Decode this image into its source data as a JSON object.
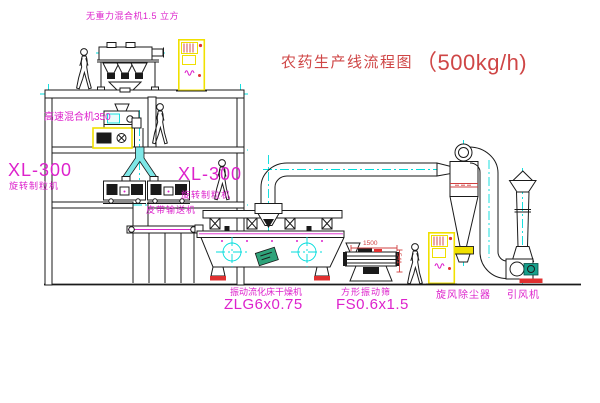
{
  "title": {
    "zh": "农药生产线流程图",
    "capacity": "（500kg/h)"
  },
  "labels": {
    "gravity_mixer": "无重力混合机1.5 立方",
    "high_speed_mixer": "高速混合机350",
    "granulator_model_left": "XL-300",
    "granulator_left": "旋转制粒机",
    "granulator_model_center": "XL-300",
    "granulator_center": "旋转制粒机",
    "belt_conveyor": "皮带输送机",
    "dryer_name": "振动流化床干燥机",
    "dryer_model": "ZLG6x0.75",
    "sieve_name": "方形振动筛",
    "sieve_model": "FS0.6x1.5",
    "cyclone": "旋风除尘器",
    "fan": "引风机"
  },
  "dims": {
    "sieve_length": "1500",
    "sieve_height": "541"
  },
  "colors": {
    "ink": "#1a1a1a",
    "cyan": "#00dcdc",
    "magenta": "#dd22cc",
    "titlered": "#cf4646",
    "dimred": "#d04040",
    "basered": "#e03030",
    "yellow": "#f0e000",
    "teal": "#17a08c",
    "green": "#2fa37a",
    "chute": "#7ee7e7"
  }
}
